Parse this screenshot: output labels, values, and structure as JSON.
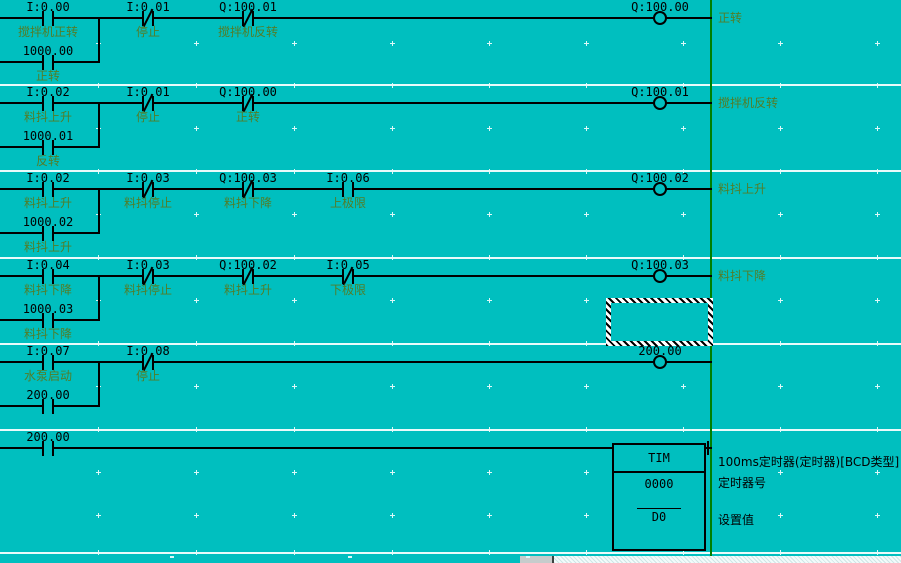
{
  "app": "ladder-logic-editor",
  "colors": {
    "background": "#00BFBF",
    "wire": "#000000",
    "address_text": "#000000",
    "comment_text": "#527d28",
    "right_bus": "#008000",
    "rung_separator": "#e9fbfb",
    "grid_dot": "#dcf8f8",
    "selection_hatch_dark": "#000000",
    "selection_hatch_light": "#ffffff"
  },
  "rungs": [
    {
      "top": 0,
      "wire_y": 18,
      "contacts": [
        {
          "x": 48,
          "type": "NO",
          "address": "I:0.00",
          "label": "搅拌机正转"
        },
        {
          "x": 148,
          "type": "NC",
          "address": "I:0.01",
          "label": "停止"
        },
        {
          "x": 248,
          "type": "NC",
          "address": "Q:100.01",
          "label": "搅拌机反转"
        }
      ],
      "branch": {
        "contact_x": 48,
        "y": 62,
        "join_x": 98,
        "type": "NO",
        "address": "1000.00",
        "label": "正转"
      },
      "coil": {
        "x": 660,
        "address": "Q:100.00"
      },
      "comment": "正转"
    },
    {
      "top": 85,
      "wire_y": 103,
      "contacts": [
        {
          "x": 48,
          "type": "NO",
          "address": "I:0.02",
          "label": "料抖上升"
        },
        {
          "x": 148,
          "type": "NC",
          "address": "I:0.01",
          "label": "停止"
        },
        {
          "x": 248,
          "type": "NC",
          "address": "Q:100.00",
          "label": "正转"
        }
      ],
      "branch": {
        "contact_x": 48,
        "y": 147,
        "join_x": 98,
        "type": "NO",
        "address": "1000.01",
        "label": "反转"
      },
      "coil": {
        "x": 660,
        "address": "Q:100.01"
      },
      "comment": "搅拌机反转"
    },
    {
      "top": 171,
      "wire_y": 189,
      "contacts": [
        {
          "x": 48,
          "type": "NO",
          "address": "I:0.02",
          "label": "料抖上升"
        },
        {
          "x": 148,
          "type": "NC",
          "address": "I:0.03",
          "label": "料抖停止"
        },
        {
          "x": 248,
          "type": "NC",
          "address": "Q:100.03",
          "label": "料抖下降"
        },
        {
          "x": 348,
          "type": "NO",
          "address": "I:0.06",
          "label": "上极限"
        }
      ],
      "branch": {
        "contact_x": 48,
        "y": 233,
        "join_x": 98,
        "type": "NO",
        "address": "1000.02",
        "label": "料抖上升"
      },
      "coil": {
        "x": 660,
        "address": "Q:100.02"
      },
      "comment": "料抖上升"
    },
    {
      "top": 258,
      "wire_y": 276,
      "contacts": [
        {
          "x": 48,
          "type": "NO",
          "address": "I:0.04",
          "label": "料抖下降"
        },
        {
          "x": 148,
          "type": "NC",
          "address": "I:0.03",
          "label": "料抖停止"
        },
        {
          "x": 248,
          "type": "NC",
          "address": "Q:100.02",
          "label": "料抖上升"
        },
        {
          "x": 348,
          "type": "NC",
          "address": "I:0.05",
          "label": "下极限"
        }
      ],
      "branch": {
        "contact_x": 48,
        "y": 320,
        "join_x": 98,
        "type": "NO",
        "address": "1000.03",
        "label": "料抖下降"
      },
      "coil": {
        "x": 660,
        "address": "Q:100.03"
      },
      "comment": "料抖下降"
    },
    {
      "top": 344,
      "wire_y": 362,
      "contacts": [
        {
          "x": 48,
          "type": "NO",
          "address": "I:0.07",
          "label": "水泵启动"
        },
        {
          "x": 148,
          "type": "NC",
          "address": "I:0.08",
          "label": "停止"
        }
      ],
      "branch": {
        "contact_x": 48,
        "y": 406,
        "join_x": 98,
        "type": "NO",
        "address": "200.00",
        "label": ""
      },
      "coil": {
        "x": 660,
        "address": "200.00"
      },
      "comment": ""
    },
    {
      "top": 430,
      "wire_y": 448,
      "contacts": [
        {
          "x": 48,
          "type": "NO",
          "address": "200.00",
          "label": ""
        }
      ],
      "instruction": {
        "mnemonic": "TIM",
        "operand1": "0000",
        "operand2": "D0",
        "box": {
          "x": 612,
          "y": 443,
          "w": 94,
          "h": 108
        },
        "annotations": [
          "100ms定时器(定时器)[BCD类型]",
          "定时器号",
          "设置值"
        ]
      }
    }
  ],
  "selection_cursor": {
    "x": 606,
    "y": 298,
    "w": 107,
    "h": 48
  },
  "layout_marks": {
    "right_bus_x": 710,
    "separator_ys": [
      84,
      170,
      257,
      343,
      429,
      552
    ]
  }
}
